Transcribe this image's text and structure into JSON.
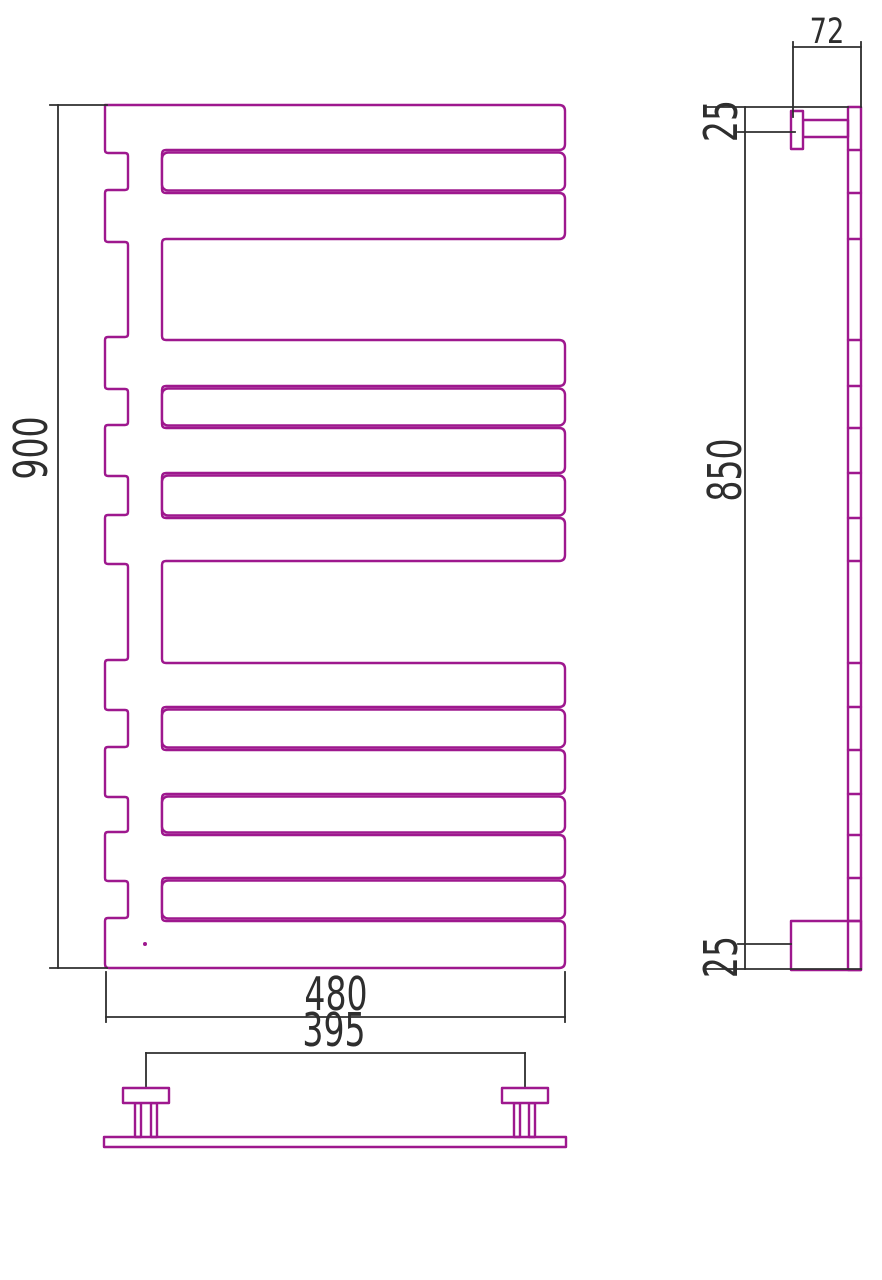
{
  "drawing": {
    "kind": "towel-rail-technical-drawing",
    "units": "mm",
    "outline_color": "#9E188E",
    "dimension_color": "#2e2e2e"
  },
  "front_view": {
    "height_label": "900",
    "width_label": "480",
    "left": 105,
    "right": 565,
    "top": 105,
    "bottom": 968,
    "notch_x": 128,
    "closure_x": 162,
    "bands": [
      {
        "t": "A",
        "y0": 105,
        "y1": 150
      },
      {
        "t": "B",
        "y0": 150,
        "y1": 193
      },
      {
        "t": "A",
        "y0": 193,
        "y1": 239
      },
      {
        "t": "G",
        "y0": 239,
        "y1": 340
      },
      {
        "t": "A",
        "y0": 340,
        "y1": 386
      },
      {
        "t": "B",
        "y0": 386,
        "y1": 428
      },
      {
        "t": "A",
        "y0": 428,
        "y1": 473
      },
      {
        "t": "B",
        "y0": 473,
        "y1": 518
      },
      {
        "t": "A",
        "y0": 518,
        "y1": 561
      },
      {
        "t": "G",
        "y0": 561,
        "y1": 663
      },
      {
        "t": "A",
        "y0": 663,
        "y1": 707
      },
      {
        "t": "B",
        "y0": 707,
        "y1": 750
      },
      {
        "t": "A",
        "y0": 750,
        "y1": 794
      },
      {
        "t": "B",
        "y0": 794,
        "y1": 835
      },
      {
        "t": "A",
        "y0": 835,
        "y1": 878
      },
      {
        "t": "B",
        "y0": 878,
        "y1": 921
      },
      {
        "t": "A",
        "y0": 921,
        "y1": 968
      }
    ],
    "drain_dot": {
      "x": 145,
      "y": 944
    },
    "dim_segments": [
      [
        50,
        105,
        107,
        105
      ],
      [
        50,
        968,
        107,
        968
      ],
      [
        58,
        105,
        58,
        968
      ],
      [
        106,
        972,
        106,
        1022
      ],
      [
        565,
        972,
        565,
        1022
      ],
      [
        106,
        1017,
        565,
        1017
      ]
    ]
  },
  "side_view": {
    "width_label": "72",
    "top_offset_label": "25",
    "height_label": "850",
    "bottom_offset_label": "25",
    "rail": {
      "x0": 848,
      "x1": 861,
      "y0": 107,
      "y1": 970
    },
    "top_bracket": {
      "plate": [
        791,
        111,
        12,
        38
      ],
      "arm": [
        803,
        120,
        45,
        17
      ]
    },
    "bottom_bracket": {
      "plate": [
        791,
        921,
        70,
        49
      ]
    },
    "dim_segments": [
      [
        793,
        42,
        793,
        117
      ],
      [
        861,
        42,
        861,
        107
      ],
      [
        793,
        47,
        861,
        47
      ],
      [
        705,
        107,
        848,
        107
      ],
      [
        738,
        132,
        795,
        132
      ],
      [
        745,
        107,
        745,
        969
      ],
      [
        738,
        944,
        791,
        944
      ],
      [
        705,
        969,
        861,
        969
      ]
    ]
  },
  "bottom_view": {
    "span_label": "395",
    "base": [
      104,
      1137,
      462,
      10
    ],
    "left_bracket": {
      "plate": [
        123,
        1088,
        46,
        15
      ],
      "legs": [
        [
          135,
          1103,
          6,
          34
        ],
        [
          151,
          1103,
          6,
          34
        ]
      ]
    },
    "right_bracket": {
      "plate": [
        502,
        1088,
        46,
        15
      ],
      "legs": [
        [
          514,
          1103,
          6,
          34
        ],
        [
          529,
          1103,
          6,
          34
        ]
      ]
    },
    "dim_segments": [
      [
        146,
        1053,
        525,
        1053
      ],
      [
        146,
        1053,
        146,
        1086
      ],
      [
        525,
        1053,
        525,
        1086
      ]
    ]
  }
}
